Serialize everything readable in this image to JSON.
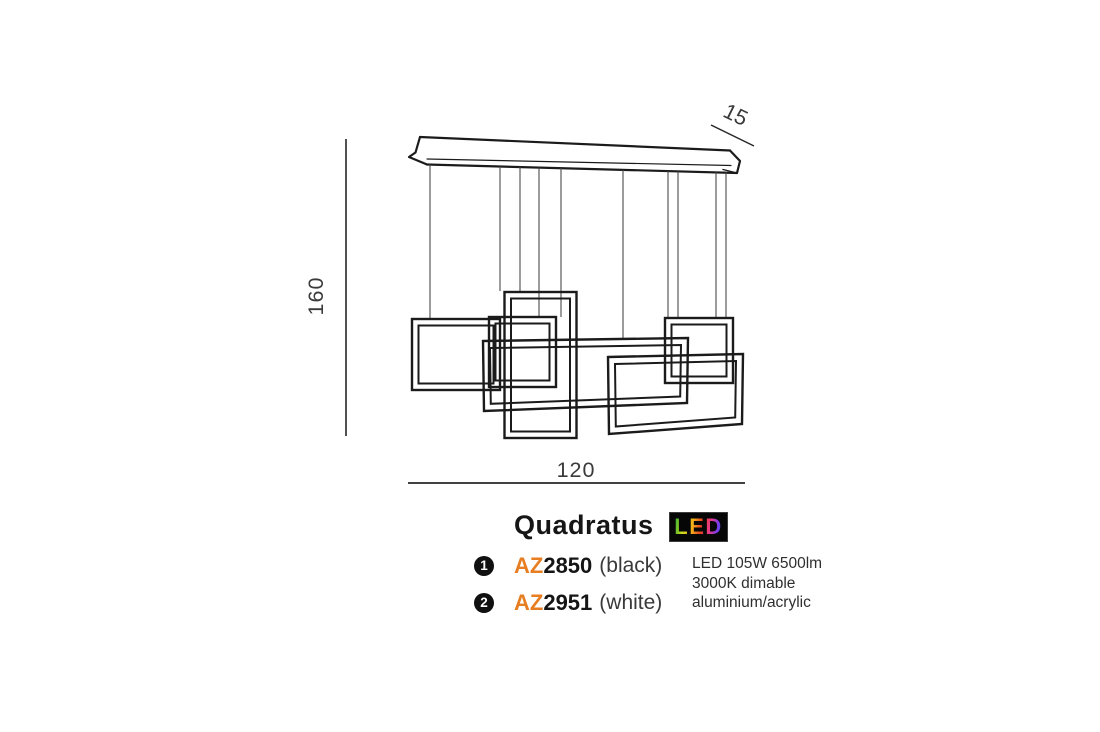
{
  "diagram": {
    "dimensions": {
      "height_label": "160",
      "width_label": "120",
      "depth_label": "15"
    }
  },
  "product": {
    "name": "Quadratus",
    "led_badge": "LED",
    "variants": [
      {
        "number": "1",
        "prefix": "AZ",
        "code": "2850",
        "finish": "(black)"
      },
      {
        "number": "2",
        "prefix": "AZ",
        "code": "2951",
        "finish": "(white)"
      }
    ],
    "specs": {
      "line1": "LED 105W 6500lm",
      "line2": "3000K dimable",
      "line3": "aluminium/acrylic"
    }
  },
  "colors": {
    "accent_orange": "#e87e22",
    "line_black": "#1b1b1b",
    "badge_background": "#060606"
  }
}
